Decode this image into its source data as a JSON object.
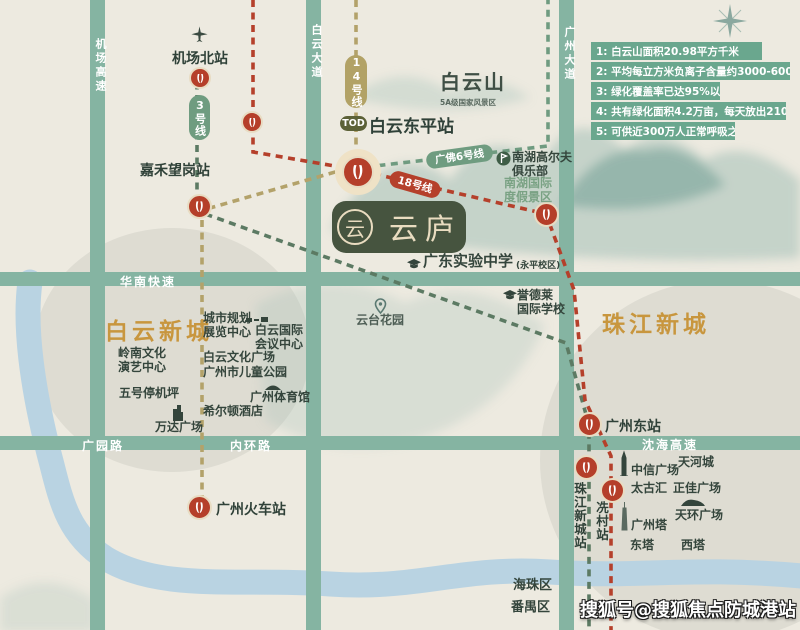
{
  "colors": {
    "background": "#edeae0",
    "road": "#85b4a2",
    "river": "#b9d3e2",
    "line3_green": "#5c7a63",
    "line14_olive": "#b3a26a",
    "line18_red": "#b5402b",
    "line6_green": "#6f9b80",
    "station_red": "#b53f2a",
    "gold_title": "#c8963e",
    "logo_green": "#46543f",
    "legend_bar": "#6aa78e"
  },
  "icons": [
    "airplane-icon",
    "compass-icon",
    "metro-station-icon",
    "graduation-cap-icon",
    "golf-flag-icon",
    "location-pin-icon",
    "tower-icon",
    "canton-tower-icon",
    "building-icon",
    "stadium-icon",
    "conference-center-icon"
  ],
  "legend": {
    "items": [
      "1: 白云山面积20.98平方千米",
      "2: 平均每立方米负离子含量约3000-6000个",
      "3: 绿化覆盖率已达95%以上",
      "4: 共有绿化面积4.2万亩，每天放出2100吨氧气，",
      "5: 可供近300万人正常呼吸之用"
    ]
  },
  "roads": {
    "airport_expwy": "机场高速",
    "baiyun_ave": "白云大道",
    "guangzhou_ave": "广州大道",
    "huanan_expwy": "华南快速",
    "guangyuan_rd": "广园路",
    "neihuan_rd": "内环路",
    "shenhai_expwy": "沈海高速"
  },
  "areas": {
    "baiyun_new_town": "白云新城",
    "zhujiang_new_town": "珠江新城",
    "haizhu": "海珠区",
    "panyu": "番禺区",
    "baiyun_mountain": "白云山",
    "baiyun_mountain_sub": "5A级国家风景区"
  },
  "metro": {
    "line3_badge": "3号线",
    "line14_badge": "14号线",
    "line18_badge": "18号线",
    "line6_badge": "广佛6号线",
    "tod_badge": "TOD",
    "stations": {
      "jichangbei": "机场北站",
      "jiahewanggang": "嘉禾望岗站",
      "baiyundongping": "白云东平站",
      "guangzhou_railway": "广州火车站",
      "guangzhoudong": "广州东站",
      "zhujiangxincheng": "珠江新城站",
      "xiancun": "冼村站"
    }
  },
  "landmarks": {
    "lingnan": "岭南文化\n演艺中心",
    "wuhao": "五号停机坪",
    "guihua": "城市规划\n展览中心",
    "huiyi": "白云国际\n会议中心",
    "wenhua": "白云文化广场",
    "ertong": "广州市儿童公园",
    "tiyuguan": "广州体育馆",
    "xierdun": "希尔顿酒店",
    "wanda": "万达广场",
    "yuntai": "云台花园",
    "shiyan": "广东实验中学",
    "shiyan_sub": "(永平校区)",
    "yudelai": "誉德莱\n国际学校",
    "nanhu_golf": "南湖高尔夫\n俱乐部",
    "nanhu_resort": "南湖国际\n度假景区",
    "zhongxin": "中信广场",
    "tianhecheng": "天河城",
    "taiguhui": "太古汇",
    "zhengjia": "正佳广场",
    "tianhuan": "天环广场",
    "guangzhouta": "广州塔",
    "dongta": "东塔",
    "xita": "西塔"
  },
  "logo": {
    "name": "云庐",
    "seal": "云"
  },
  "watermark": "搜狐号@搜狐焦点防城港站"
}
